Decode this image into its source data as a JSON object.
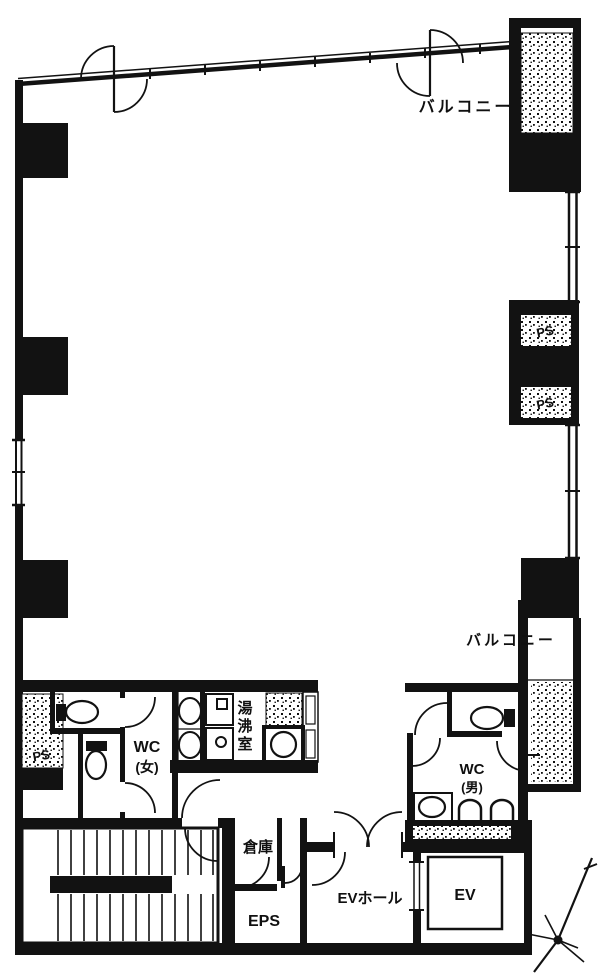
{
  "drawing": {
    "type": "architectural floor plan",
    "colors": {
      "ink": "#121212",
      "paper": "#ffffff"
    }
  },
  "labels": {
    "balcony_top": "バルコニー",
    "balcony_mid": "バルコニー",
    "ps_right_upper": "PS",
    "ps_right_lower": "PS",
    "ps_left": "PS",
    "wc_women_line1": "WC",
    "wc_women_line2": "(女)",
    "wc_men_line1": "WC",
    "wc_men_line2": "(男)",
    "kitchenette": "湯沸室",
    "storage": "倉庫",
    "eps": "EPS",
    "ev_hall": "EVホール",
    "ev": "EV"
  }
}
